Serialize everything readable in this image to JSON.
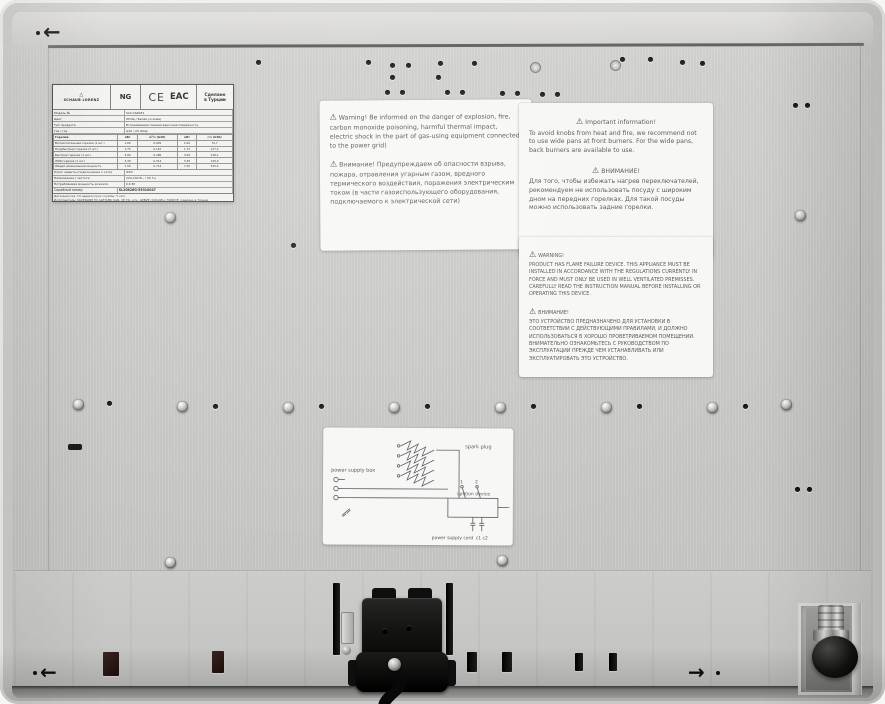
{
  "arrows": {
    "left": "←",
    "right": "→"
  },
  "rating_plate": {
    "brand": "SCHAUB LORENZ",
    "gas_type": "NG",
    "ce_mark": "CE",
    "eac_mark": "EAC",
    "made_in_line1": "Сделано",
    "made_in_line2": "в Турции",
    "specs": [
      {
        "label": "Модель №",
        "value": "SLK GS6031"
      },
      {
        "label": "Цвет",
        "value": "White / Белая (основа)"
      },
      {
        "label": "Тип продукта",
        "value": "Встраиваемая газовая варочная поверхность"
      },
      {
        "label": "Газ / газ",
        "value": "G20 / 20 мбар"
      }
    ],
    "burner_table": {
      "header": [
        "Горелки",
        "кВт",
        "м³/ч (G20)",
        "кВт",
        "г/ч (G30)"
      ],
      "rows": [
        [
          "Вспомогательная горелка (1 шт.)",
          "1,00",
          "0,095",
          "1,00",
          "72,7"
        ],
        [
          "Полубыстрая горелка (2 шт.)",
          "1,75",
          "0,167",
          "1,75",
          "127,2"
        ],
        [
          "Быстрая горелка (1 шт.)",
          "3,00",
          "0,286",
          "3,00",
          "218,1"
        ],
        [
          "WOK-горелка (1 шт.)",
          "3,30",
          "0,314",
          "3,30",
          "239,9"
        ],
        [
          "Общая номинальная мощность",
          "7,50",
          "0,714",
          "7,50",
          "545,4"
        ]
      ]
    },
    "extra_rows": [
      {
        "label": "Класс защиты (подключение к сети)",
        "value": "IP20"
      },
      {
        "label": "Напряжение / частота",
        "value": "220-240 В~ / 50 Гц"
      },
      {
        "label": "Потребляемая мощность розжига",
        "value": "0,6 Вт"
      }
    ],
    "serial_label": "Серийный номер",
    "serial_value": "SL20826G-55310047",
    "footer_lines": [
      "Дата выпуска: 13 неделя (срок службы: 5 лет)",
      "Изготовитель: SILVERLINE EV ALETLERI SAN. VE TIC. A.S., GEBZE / KOCAELI, TURKIYE. Сделано в Турции",
      "Декларация о соответствии: см. сопроводительную документацию. Не оставляйте работающий прибор без присмотра",
      "Импортер / организация, уполномоченная на принятие претензий: см. гарантийный талон",
      "Адрес: РФ, г. Москва. Сервисное обслуживание — по телефону горячей линии",
      "Тел.: +7-495-287-98-28"
    ],
    "warning_icons": "⚠ ⚠ ⚠",
    "barcode_number": "8 690934 491705"
  },
  "stickers": {
    "explosion": {
      "en": "Warning! Be informed on the danger of explosion, fire, carbon monoxide poisoning, harmful thermal impact, electric shock in the part of gas-using equipment connected to the power grid)",
      "ru": "Внимание! Предупреждаем об опасности взрыва, пожара, отравления угарным газом, вредного термического воздействия, поражения электрическим током (в части газоиспользующего оборудования, подключаемого к электрической сети)"
    },
    "pans": {
      "en_title": "Important information!",
      "en_body": "To avoid knobs from heat and fire, we recommend not to use wide pans at front burners. For the wide pans, back burners are available to use.",
      "ru_title": "ВНИМАНИЕ!",
      "ru_body": "Для того, чтобы избежать нагрев переключателей, рекомендуем не использовать посуду с широким дном на передних горелках. Для такой посуды можно использовать задние горелки."
    },
    "flame": {
      "en_title": "WARNING!",
      "en_body": "PRODUCT HAS FLAME FAILURE DEVICE. THIS APPLIANCE MUST BE INSTALLED IN ACCORDANCE WITH THE REGULATIONS CURRENTLY IN FORCE AND MUST ONLY BE USED IN WELL VENTILATED PREMISSES. CAREFULLY READ THE INSTRUCTION MANUAL BEFORE INSTALLING OR OPERATING THIS DEVICE.",
      "ru_title": "ВНИМАНИЕ!",
      "ru_body": "ЭТО УСТРОЙСТВО ПРЕДНАЗНАЧЕНО ДЛЯ УСТАНОВКИ В СООТВЕТСТВИИ С ДЕЙСТВУЮЩИМИ ПРАВИЛАМИ, И ДОЛЖНО ИСПОЛЬЗОВАТЬСЯ В ХОРОШО ПРОВЕТРИВАЕМОМ ПОМЕЩЕНИИ. ВНИМАТЕЛЬНО ОЗНАКОМЬТЕСЬ С РУКОВОДСТВОМ ПО ЭКСПЛУАТАЦИИ ПРЕЖДЕ ЧЕМ УСТАНАВЛИВАТЬ ИЛИ ЭКСПЛУАТИРОВАТЬ ЭТО УСТРОЙСТВО."
    }
  },
  "wiring": {
    "labels": {
      "power_box": "power supply box",
      "spark": "spark plug",
      "ignition": "ignition device",
      "cord": "power supply cord",
      "caps": "c1  c2",
      "sw1": "1",
      "sw2": "2"
    }
  }
}
